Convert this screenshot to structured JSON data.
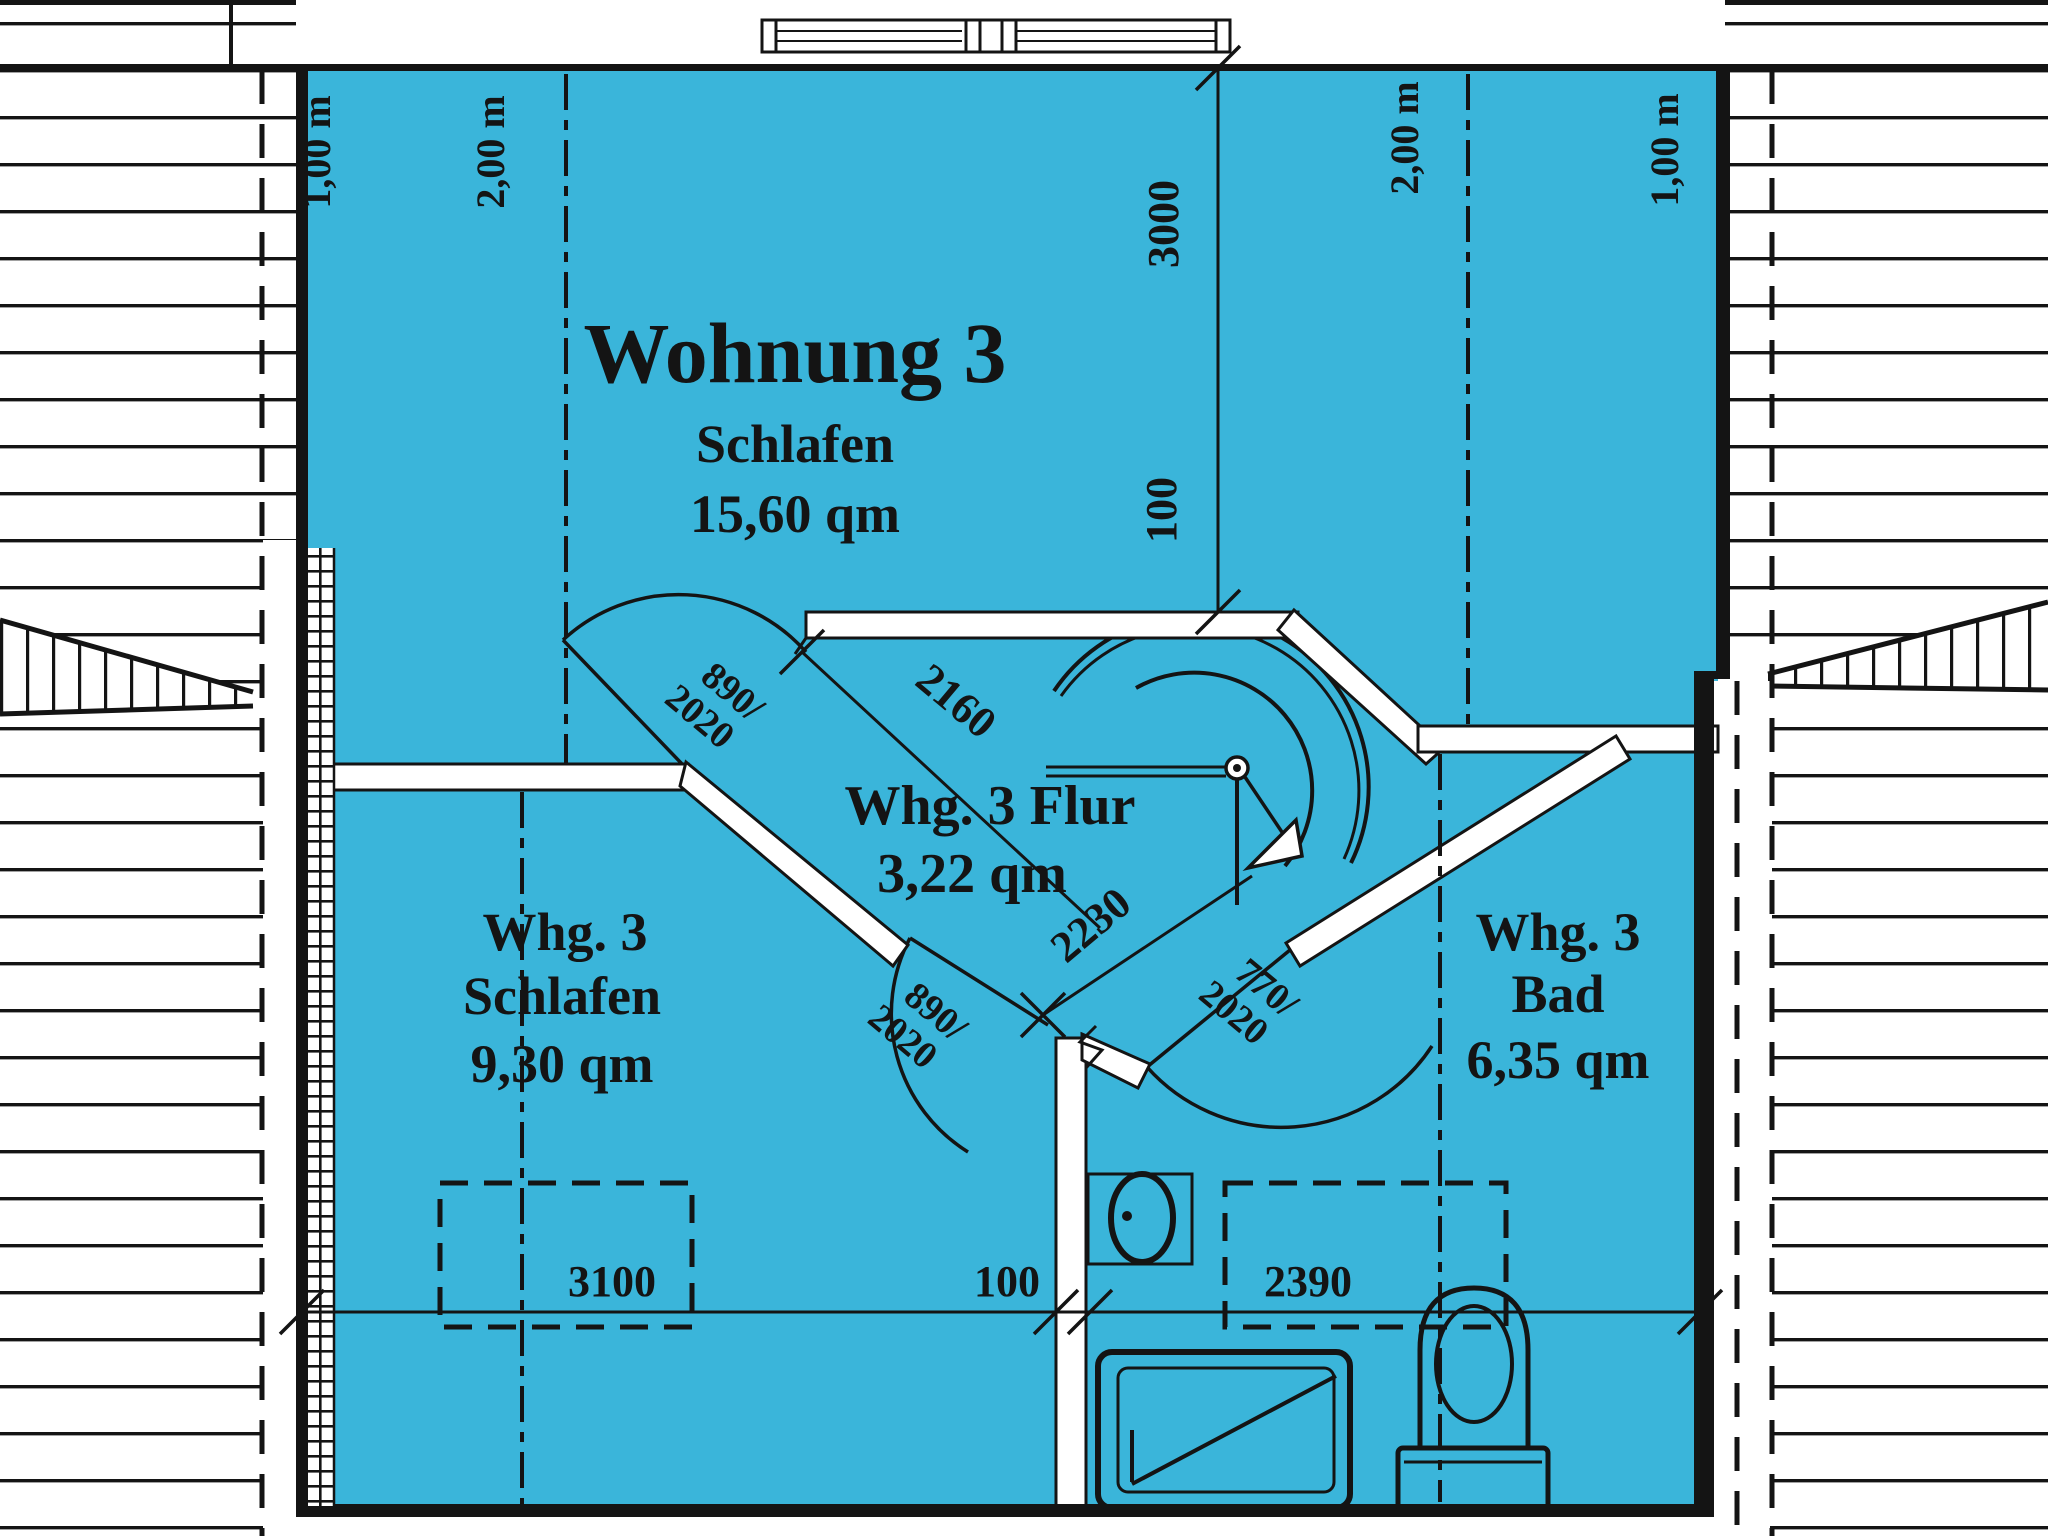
{
  "colors": {
    "floor": "#3ab5da",
    "line": "#141414",
    "paper": "#ffffff"
  },
  "main_room": {
    "title": "Wohnung 3",
    "name": "Schlafen",
    "area": "15,60 qm"
  },
  "flur": {
    "name": "Whg. 3 Flur",
    "area": "3,22 qm"
  },
  "schlafen_klein": {
    "unit": "Whg. 3",
    "name": "Schlafen",
    "area": "9,30 qm"
  },
  "bad": {
    "unit": "Whg. 3",
    "name": "Bad",
    "area": "6,35 qm"
  },
  "height_lines": {
    "left_1m": "1,00 m",
    "left_2m": "2,00 m",
    "right_2m": "2,00 m",
    "right_1m": "1,00 m"
  },
  "dims": {
    "v3000": "3000",
    "v100": "100",
    "d2160": "2160",
    "d2230": "2230",
    "b3100": "3100",
    "b100": "100",
    "b2390": "2390"
  },
  "doors": {
    "d1a": "890/",
    "d1b": "2020",
    "d2a": "890/",
    "d2b": "2020",
    "d3a": "770/",
    "d3b": "2020"
  }
}
